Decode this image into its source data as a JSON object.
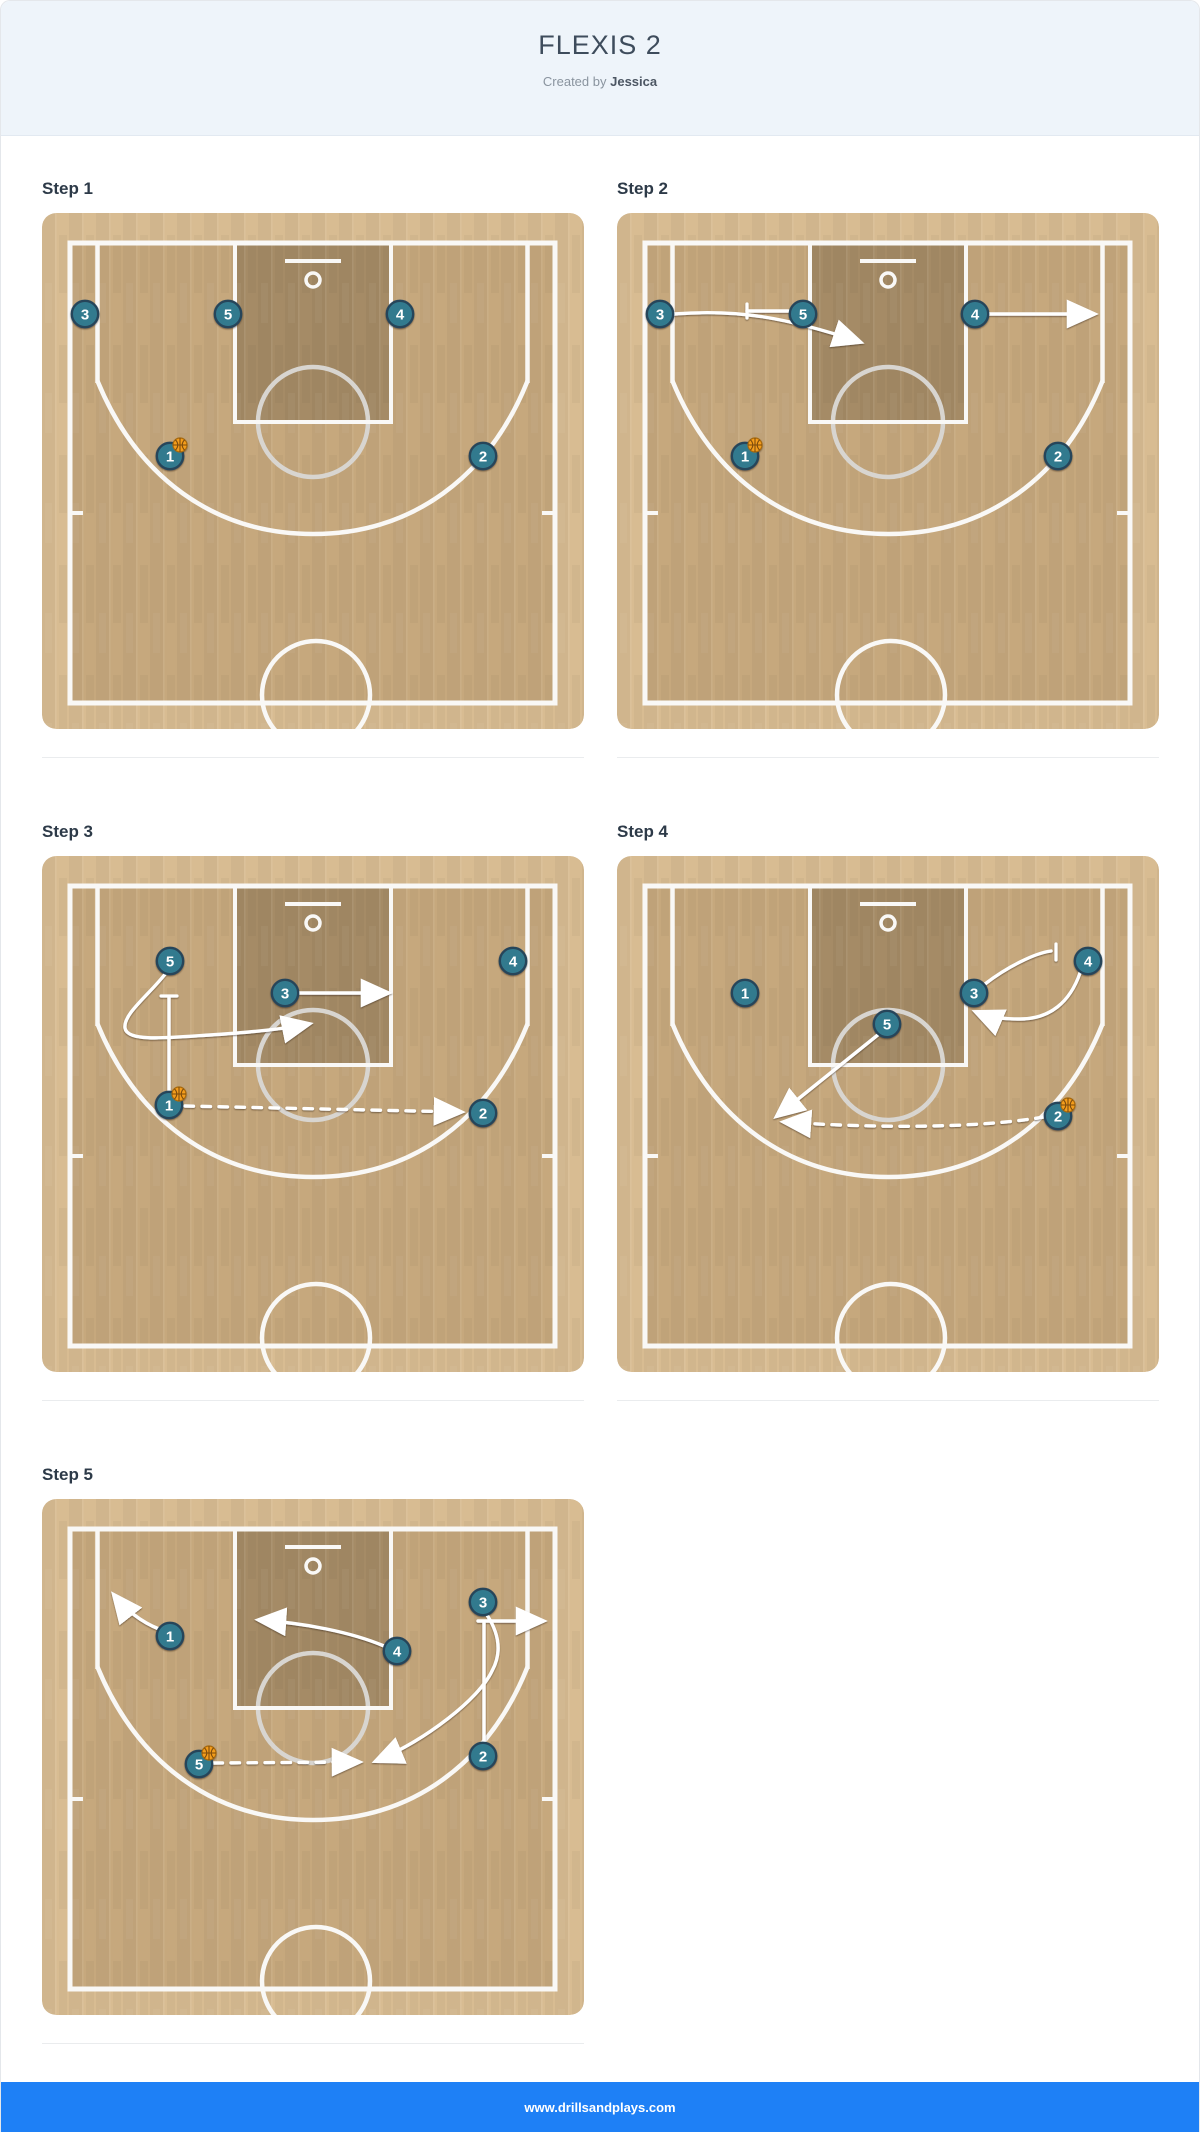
{
  "header": {
    "title": "FLEXIS 2",
    "created_by_prefix": "Created by",
    "author": "Jessica"
  },
  "footer": {
    "url": "www.drillsandplays.com"
  },
  "colors": {
    "header_bg": "#eef4fa",
    "footer_bar": "#1e80f6",
    "court_apron": "#d8bc92",
    "court_floor": "#c6a87d",
    "court_paint": "#a58b66",
    "court_line": "#f9f8f6",
    "court_ft_circle": "#d8d5d0",
    "player_fill": "#337a8e",
    "player_border": "#27455a",
    "player_number": "#ffffff",
    "ball": "#f49d1e",
    "ball_seam": "#7c4b08",
    "annotation": "#ffffff"
  },
  "steps": [
    {
      "label": "Step 1",
      "players": [
        {
          "n": "3",
          "x": 43,
          "y": 101
        },
        {
          "n": "5",
          "x": 186,
          "y": 101
        },
        {
          "n": "4",
          "x": 358,
          "y": 101
        },
        {
          "n": "1",
          "x": 128,
          "y": 243
        },
        {
          "n": "2",
          "x": 441,
          "y": 243
        }
      ],
      "ball": {
        "x": 138,
        "y": 232
      },
      "paths": []
    },
    {
      "label": "Step 2",
      "players": [
        {
          "n": "3",
          "x": 43,
          "y": 101
        },
        {
          "n": "5",
          "x": 186,
          "y": 101
        },
        {
          "n": "4",
          "x": 358,
          "y": 101
        },
        {
          "n": "1",
          "x": 128,
          "y": 243
        },
        {
          "n": "2",
          "x": 441,
          "y": 243
        }
      ],
      "ball": {
        "x": 138,
        "y": 232
      },
      "paths": [
        {
          "kind": "move",
          "d": "M57,101 C120,96 168,104 243,129",
          "arrow": true
        },
        {
          "kind": "move",
          "d": "M371,101 L477,101",
          "arrow": true
        },
        {
          "kind": "screen",
          "d": "M171,98 L130,98",
          "arrow": false,
          "tick": {
            "x1": 130,
            "y1": 91,
            "x2": 130,
            "y2": 105
          }
        }
      ]
    },
    {
      "label": "Step 3",
      "players": [
        {
          "n": "5",
          "x": 128,
          "y": 105
        },
        {
          "n": "3",
          "x": 243,
          "y": 137
        },
        {
          "n": "4",
          "x": 471,
          "y": 105
        },
        {
          "n": "1",
          "x": 127,
          "y": 249
        },
        {
          "n": "2",
          "x": 441,
          "y": 257
        }
      ],
      "ball": {
        "x": 137,
        "y": 238
      },
      "paths": [
        {
          "kind": "move",
          "d": "M124,117 C107,139 81,158 83,172 C85,186 124,182 168,179 C214,176 247,172 267,168",
          "arrow": true
        },
        {
          "kind": "move",
          "d": "M258,137 L346,137",
          "arrow": true
        },
        {
          "kind": "screen",
          "d": "M127,234 L127,142",
          "arrow": false,
          "tick": {
            "x1": 119,
            "y1": 140,
            "x2": 135,
            "y2": 140
          }
        },
        {
          "kind": "pass",
          "d": "M143,250 L419,256",
          "arrow": true
        }
      ]
    },
    {
      "label": "Step 4",
      "players": [
        {
          "n": "1",
          "x": 128,
          "y": 137
        },
        {
          "n": "3",
          "x": 357,
          "y": 137
        },
        {
          "n": "5",
          "x": 270,
          "y": 168
        },
        {
          "n": "4",
          "x": 471,
          "y": 105
        },
        {
          "n": "2",
          "x": 441,
          "y": 260
        }
      ],
      "ball": {
        "x": 451,
        "y": 249
      },
      "paths": [
        {
          "kind": "screen",
          "d": "M368,128 C390,111 418,97 434,95",
          "arrow": false,
          "tick": {
            "x1": 439,
            "y1": 88,
            "x2": 439,
            "y2": 104
          }
        },
        {
          "kind": "move",
          "d": "M463,117 C453,146 433,163 403,163 C378,163 366,159 359,156",
          "arrow": true
        },
        {
          "kind": "move",
          "d": "M262,178 L160,260",
          "arrow": true
        },
        {
          "kind": "pass",
          "d": "M427,261 C350,274 240,271 167,266",
          "arrow": true
        }
      ]
    },
    {
      "label": "Step 5",
      "players": [
        {
          "n": "1",
          "x": 128,
          "y": 137
        },
        {
          "n": "4",
          "x": 355,
          "y": 152
        },
        {
          "n": "3",
          "x": 441,
          "y": 103
        },
        {
          "n": "2",
          "x": 441,
          "y": 257
        },
        {
          "n": "5",
          "x": 157,
          "y": 265
        }
      ],
      "ball": {
        "x": 167,
        "y": 254
      },
      "paths": [
        {
          "kind": "move",
          "d": "M117,130 C99,123 83,110 72,96",
          "arrow": true
        },
        {
          "kind": "move",
          "d": "M342,147 C309,133 262,124 217,121",
          "arrow": true
        },
        {
          "kind": "move",
          "d": "M445,116 C456,133 461,152 450,172 C437,200 384,241 334,262",
          "arrow": true
        },
        {
          "kind": "screen",
          "d": "M442,243 L442,124",
          "arrow": false
        },
        {
          "kind": "move",
          "d": "M436,122 L501,122",
          "arrow": true
        },
        {
          "kind": "pass",
          "d": "M172,264 L317,263",
          "arrow": true
        }
      ]
    }
  ]
}
